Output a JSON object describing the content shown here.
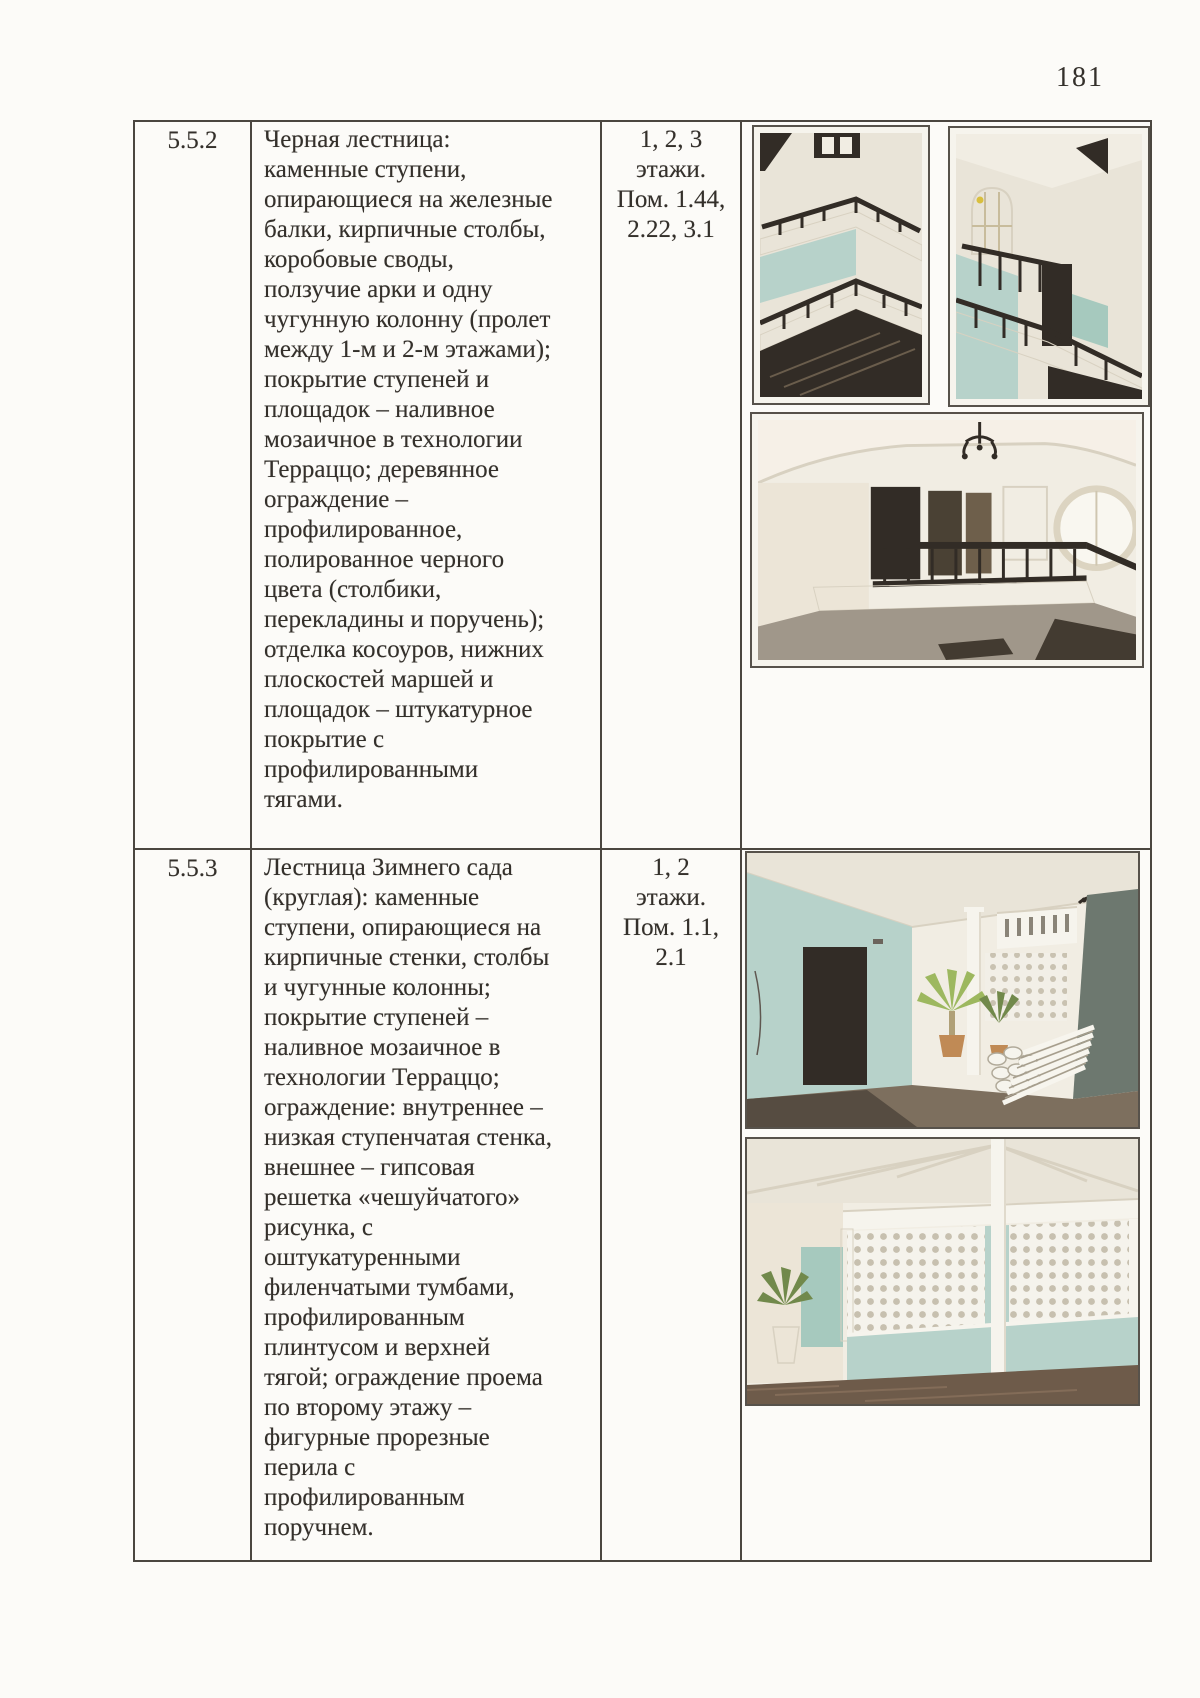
{
  "page": {
    "number": "181"
  },
  "colors": {
    "page_bg": "#fcfbf8",
    "ink": "#34302b",
    "border": "#4b4640",
    "photo_white": "#f6f4ed",
    "cream": "#e9e4d8",
    "cream_bright": "#f1ede3",
    "mint": "#b7d2ca",
    "mint_dark": "#a6c9be",
    "dark_wood": "#322c26",
    "floor_brown": "#6e5b4a",
    "floor_gray": "#a0978a",
    "green": "#9db85f",
    "green_dark": "#71894b",
    "clay": "#c08a55",
    "gray_green": "#6d786f",
    "trim": "#d8d1c1"
  },
  "table": {
    "rows": [
      {
        "id": "5.5.2",
        "description_lines": [
          "Черная лестница:",
          "каменные ступени,",
          "опирающиеся на железные",
          "балки, кирпичные столбы,",
          "коробовые своды,",
          "ползучие арки и одну",
          "чугунную колонну (пролет",
          "между 1-м и 2-м этажами);",
          "покрытие ступеней и",
          "площадок – наливное",
          "мозаичное в технологии",
          "Терраццо; деревянное",
          "ограждение –",
          "профилированное,",
          "полированное черного",
          "цвета (столбики,",
          "перекладины и поручень);",
          "отделка косоуров, нижних",
          "плоскостей маршей и",
          "площадок – штукатурное",
          "покрытие с",
          "профилированными",
          "тягами."
        ],
        "location_lines": [
          "1, 2, 3",
          "этажи.",
          "Пом. 1.44,",
          "2.22, 3.1"
        ],
        "photo_alts": [
          "Вид лестничных маршей с черным деревянным ограждением снизу вверх",
          "Марш черной лестницы с арочным окном и черным ограждением",
          "Площадка с ограждением проема лестницы и круглым окном"
        ]
      },
      {
        "id": "5.5.3",
        "description_lines": [
          "Лестница Зимнего сада",
          "(круглая): каменные",
          "ступени, опирающиеся на",
          "кирпичные стенки, столбы",
          "и чугунные колонны;",
          "покрытие ступеней –",
          "наливное мозаичное в",
          "технологии Терраццо;",
          "ограждение: внутреннее –",
          "низкая ступенчатая стенка,",
          "внешнее – гипсовая",
          "решетка «чешуйчатого»",
          "рисунка, с",
          "оштукатуренными",
          "филенчатыми тумбами,",
          "профилированным",
          "плинтусом и верхней",
          "тягой; ограждение проема",
          "по второму этажу –",
          "фигурные прорезные",
          "перила с",
          "профилированным",
          "поручнем."
        ],
        "location_lines": [
          "1, 2",
          "этажи.",
          "Пом. 1.1,",
          "2.1"
        ],
        "photo_alts": [
          "Вход у круглой лестницы Зимнего сада с пальмами и белой лестницей",
          "Гипсовая решетка чешуйчатого рисунка с колоннами Зимнего сада"
        ]
      }
    ]
  }
}
